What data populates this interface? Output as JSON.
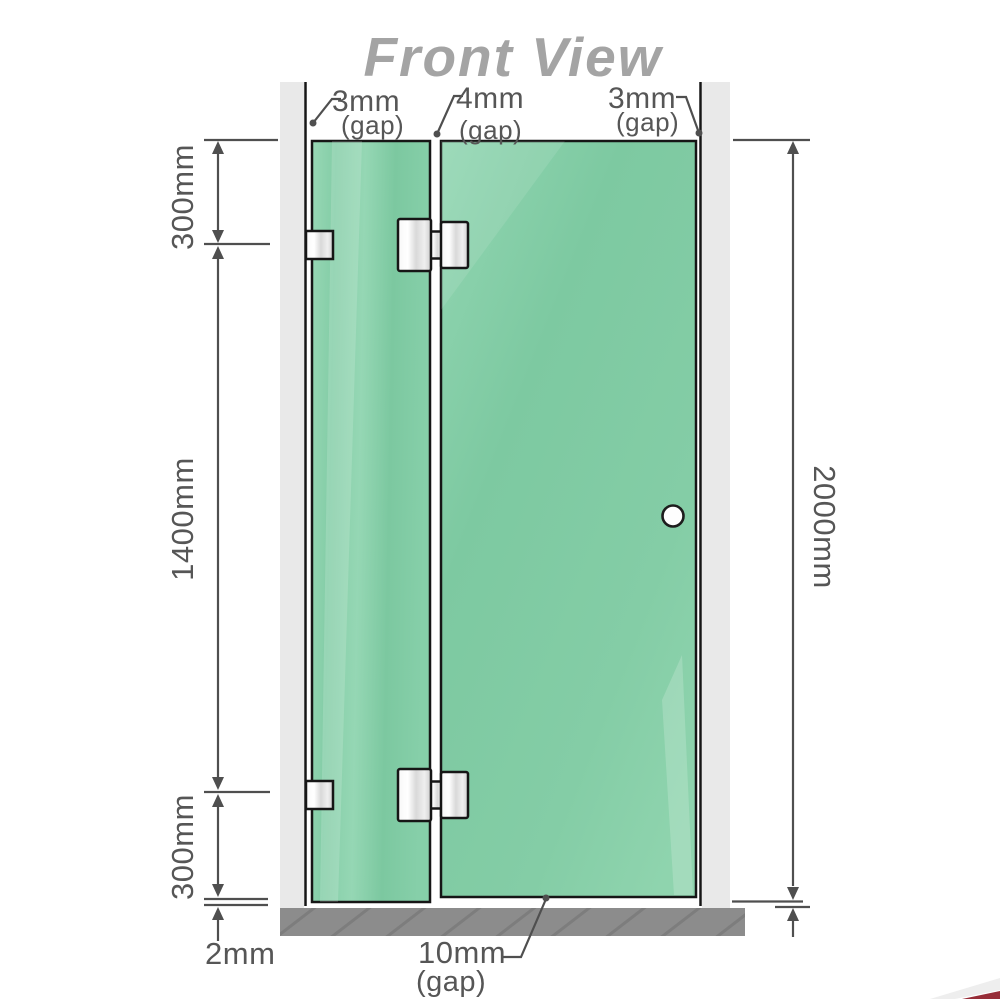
{
  "title": "Front View",
  "top_gap_labels": [
    {
      "value": "3mm",
      "note": "(gap)"
    },
    {
      "value": "4mm",
      "note": "(gap)"
    },
    {
      "value": "3mm",
      "note": "(gap)"
    }
  ],
  "left_dimensions": {
    "top_segment": "300mm",
    "middle_segment": "1400mm",
    "bottom_segment": "300mm",
    "floor_gap": "2mm"
  },
  "right_dimensions": {
    "total_height": "2000mm"
  },
  "bottom_gap_label": {
    "value": "10mm",
    "note": "(gap)"
  },
  "colors": {
    "glass_green": "#81cba4",
    "glass_highlight": "#9bdcb9",
    "wall_gray": "#e9e9e9",
    "floor_gray": "#8c8c8c",
    "outline_black": "#161616",
    "dimension_gray": "#565656",
    "title_gray": "#a4a4a4",
    "hinge_metal": "#e6e6e6",
    "corner_accent": "#8c1622"
  }
}
